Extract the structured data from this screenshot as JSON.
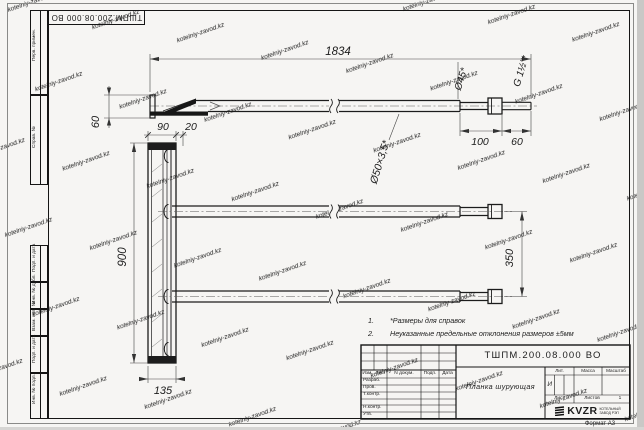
{
  "title_block": {
    "doc_number": "ТШПМ.200.08.000 ВО",
    "part_name": "Планка шурующая",
    "header_cols": [
      "Изм.",
      "Лист",
      "N докум.",
      "Подп.",
      "Дата"
    ],
    "rows": [
      "Разраб.",
      "Пров.",
      "Т.контр.",
      "Н.контр.",
      "Утв."
    ],
    "lit_header": "Лит.",
    "lit_value": "И",
    "mass_header": "Масса",
    "scale_header": "Масштаб",
    "sheet_label": "Лист",
    "sheets_label": "Листов",
    "sheets_value": "1",
    "logo_text": "KVZR",
    "logo_sub_line1": "КОТЕЛЬНЫЙ",
    "logo_sub_line2": "ЗАВОД РЭП",
    "format_label": "Формат А3"
  },
  "stamps": {
    "left_labels": [
      "Перв. примен.",
      "Справ. №",
      "Подп. и дата",
      "Инв. № дубл.",
      "Взам. инв. №",
      "Подп. и дата",
      "Инв. № подл."
    ]
  },
  "drawing": {
    "dims": {
      "total": "1834",
      "h60": "60",
      "d45": "Ø45*",
      "thread": "G 1½\"*",
      "len100": "100",
      "len60": "60",
      "pipe": "Ø50×3,5*",
      "w90": "90",
      "w20": "20",
      "h900": "900",
      "s350": "350",
      "w135": "135"
    },
    "notes": [
      {
        "num": "1.",
        "text": "*Размеры для справок"
      },
      {
        "num": "2.",
        "text": "Неуказанные предельные отклонения размеров ±5мм"
      }
    ]
  },
  "watermark": {
    "text": "kotelniy-zavod.kz"
  }
}
